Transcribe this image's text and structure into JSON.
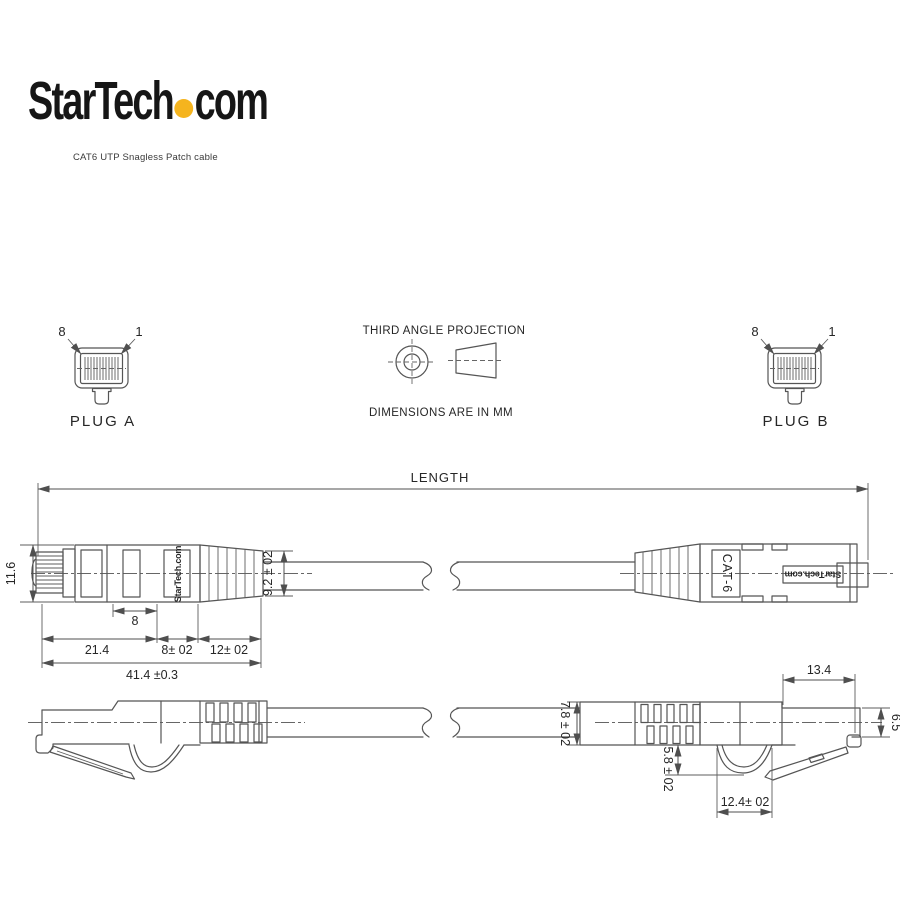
{
  "header": {
    "logo_part1": "StarTech",
    "logo_part2": "com",
    "logo_dot_color": "#F5B41E",
    "subtitle": "CAT6 UTP Snagless Patch cable"
  },
  "projection": {
    "title": "THIRD ANGLE PROJECTION",
    "units": "DIMENSIONS ARE IN MM"
  },
  "plug_a": {
    "label": "PLUG A",
    "pin_left": "8",
    "pin_right": "1"
  },
  "plug_b": {
    "label": "PLUG B",
    "pin_left": "8",
    "pin_right": "1"
  },
  "length_dim": {
    "label": "LENGTH"
  },
  "dims_top": {
    "body_height": "11.6",
    "window": "8",
    "plug_section": "21.4",
    "mid_section": "8± 02",
    "boot_section": "12± 02",
    "overall": "41.4 ±0.3",
    "boot_end_dia": "9.2 ± 02"
  },
  "dims_profile": {
    "boot_end_dia": "7.8 ± 02",
    "hook_depth": "5.8 ± 02",
    "hook_width": "12.4± 02",
    "plug_length": "13.4",
    "plug_height": "6.5"
  },
  "markings": {
    "left_connector_brand": "StarTech.com",
    "right_connector_model": "CAT-6",
    "right_connector_brand": "StarTech.com"
  },
  "style": {
    "line_color": "#555555",
    "text_color": "#262626"
  }
}
